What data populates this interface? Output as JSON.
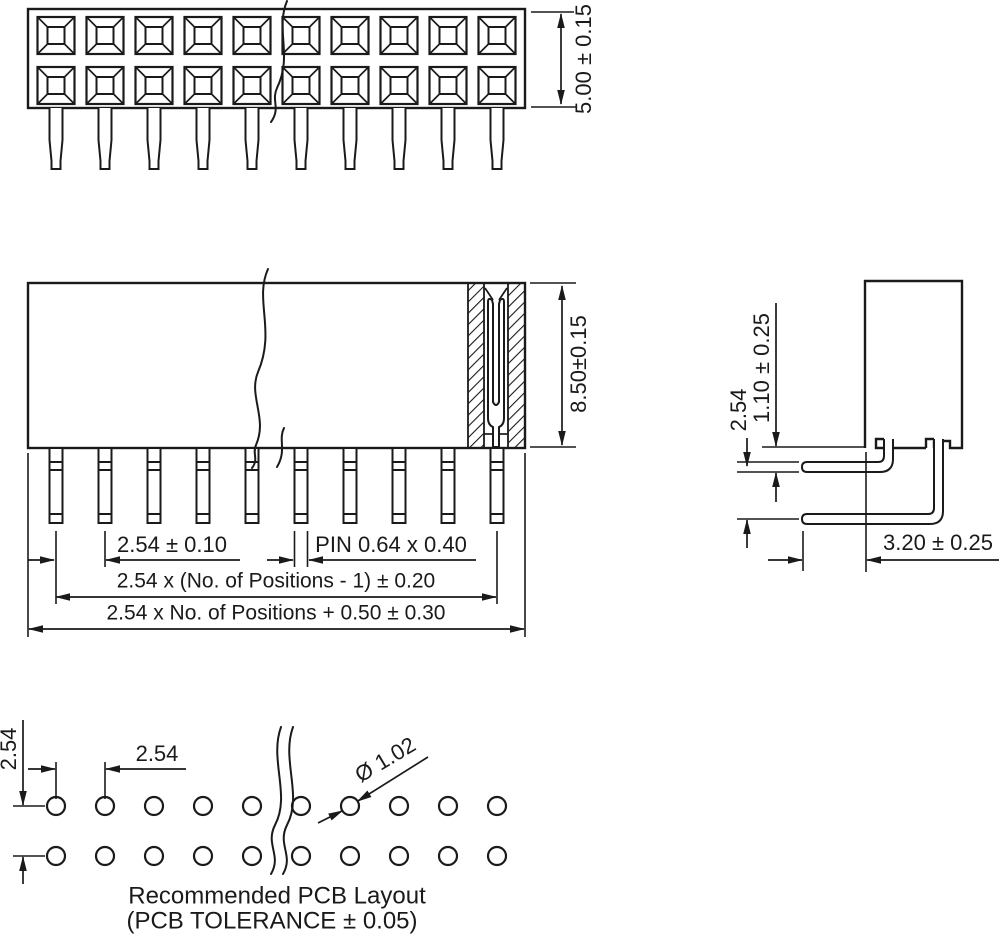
{
  "title": "Female header connector technical drawing",
  "colors": {
    "line": "#1a1a1a",
    "background": "#ffffff"
  },
  "top_view": {
    "positions": 10,
    "rows": 2,
    "height_dim": "5.00 ± 0.15"
  },
  "front_view": {
    "height_dim": "8.50±0.15",
    "pitch_dim": "2.54 ± 0.10",
    "pin_dim": "PIN 0.64 x 0.40",
    "span_centers_dim": "2.54 x (No. of Positions - 1) ± 0.20",
    "span_body_dim": "2.54 x No. of Positions + 0.50 ± 0.30"
  },
  "side_view": {
    "row_pitch_dim": "2.54",
    "pin_offset_dim": "1.10 ± 0.25",
    "tail_length_dim": "3.20 ± 0.25"
  },
  "pcb_layout": {
    "row_pitch_dim": "2.54",
    "col_pitch_dim": "2.54",
    "hole_dia_dim": "Ø 1.02",
    "caption": "Recommended PCB Layout",
    "tolerance_note": "(PCB TOLERANCE ± 0.05)"
  }
}
